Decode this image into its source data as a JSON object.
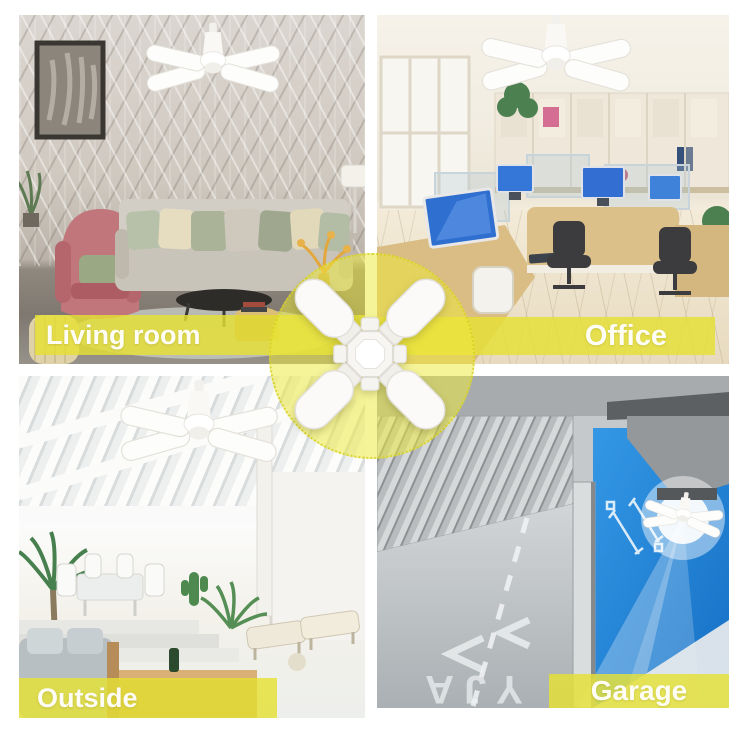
{
  "colors": {
    "background": "#ffffff",
    "accent_band_yellow": "#e5e035",
    "label_text": "#fdfdf5",
    "highlight_circle_yellow": "#eee93c",
    "garage_wall_blue": "#2486d8",
    "product_white": "#fbfaf8"
  },
  "quadrants": {
    "living_room": {
      "label": "Living room"
    },
    "office": {
      "label": "Office"
    },
    "outside": {
      "label": "Outside"
    },
    "garage": {
      "label": "Garage",
      "floor_marking": "YJA"
    }
  },
  "center_product": {
    "icon": "foldable-four-blade-led-light-icon"
  }
}
